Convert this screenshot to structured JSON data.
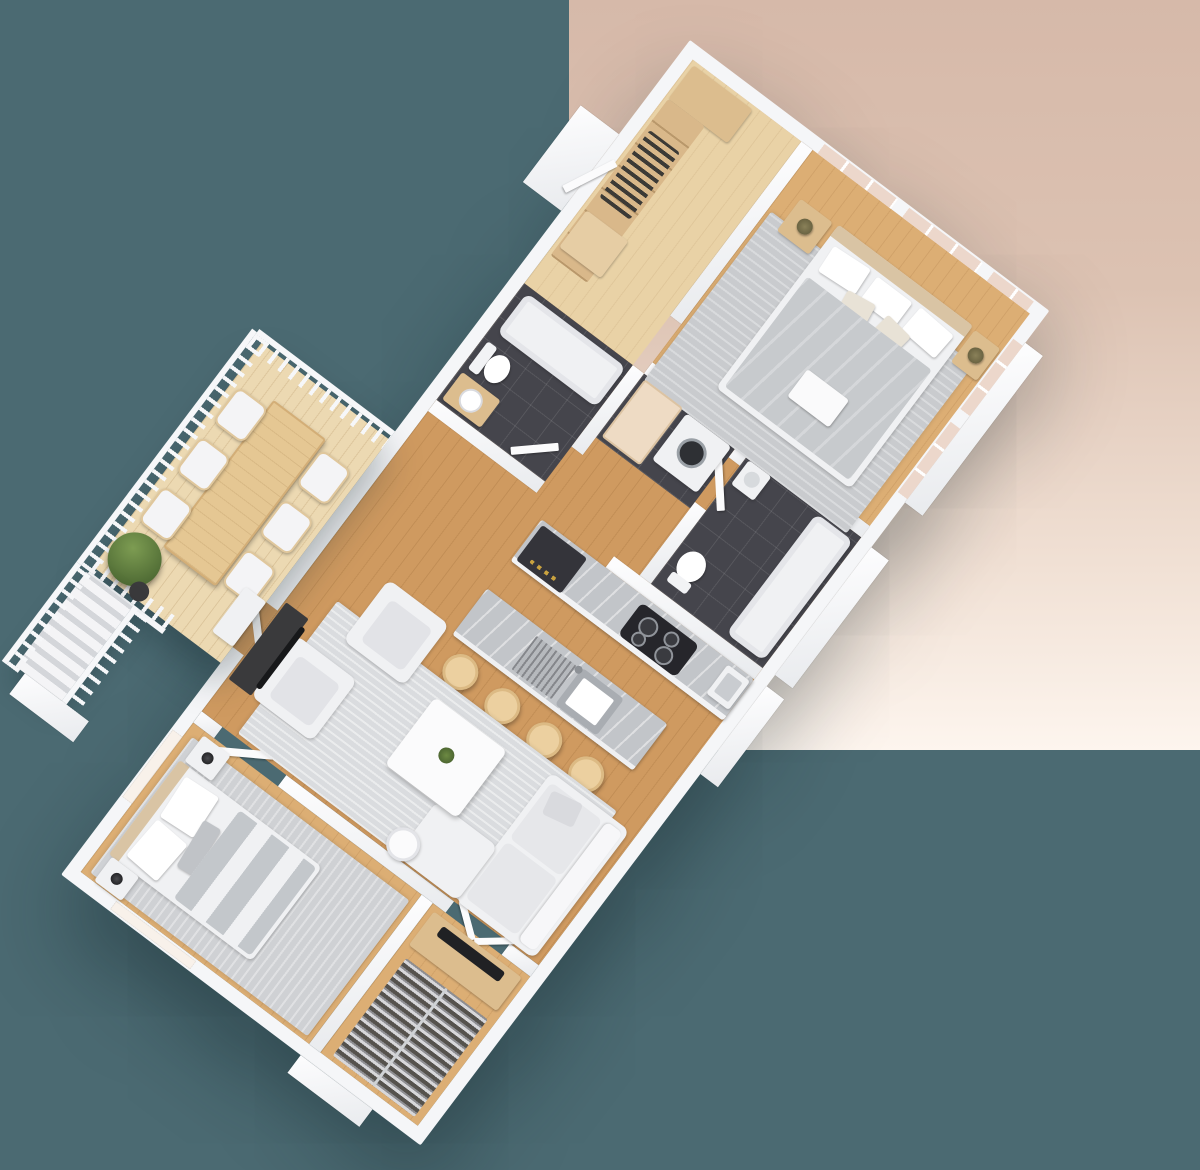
{
  "scene": {
    "type": "3d-floor-plan-render",
    "view": "isometric top-down, unit rotated diagonally",
    "visible_text": "none",
    "background": {
      "left_color": "#4b6a72",
      "panel_gradient_top": "#d6b9a9",
      "panel_gradient_bottom": "#fdf5ee",
      "panel_region": "upper-right rectangle"
    },
    "palette": {
      "walls": "#f5f6f8",
      "wood_floor": "#dcae74",
      "light_wood_floor": "#e9d2a6",
      "deck_floor": "#ecd9b2",
      "bathroom_tile": "#45454c",
      "rug": "#c9cbce",
      "counter_marble": "#c2c5c9",
      "upholstery": "#f0f1f3",
      "window_glass": "#ecd7cb"
    },
    "rooms": [
      {
        "name": "Entry foyer with closet",
        "floor": "light wood",
        "furniture": [
          "open shelving unit",
          "hanging clothes",
          "bench",
          "corner shelf"
        ]
      },
      {
        "name": "Primary bedroom",
        "floor": "wood",
        "furniture": [
          "double bed with gray duvet",
          "white pillows",
          "serving tray",
          "left nightstand with lamp",
          "right nightstand with lamp",
          "area rug"
        ]
      },
      {
        "name": "Main bathroom",
        "floor": "dark tile",
        "furniture": [
          "bathtub",
          "wall-hung toilet",
          "wood vanity with round sink"
        ]
      },
      {
        "name": "Laundry nook",
        "floor": "dark tile",
        "furniture": [
          "front-load washing machine",
          "beige work table"
        ]
      },
      {
        "name": "Ensuite bathroom",
        "floor": "dark tile",
        "furniture": [
          "bathtub",
          "toilet",
          "hand sink"
        ]
      },
      {
        "name": "Kitchen",
        "floor": "wood",
        "furniture": [
          "wall counter",
          "built-in oven and microwave block",
          "4-burner cooktop",
          "counter sink",
          "island with sink and drying rack",
          "4 wooden bar stools"
        ]
      },
      {
        "name": "Deck",
        "floor": "light decking",
        "furniture": [
          "wood dining table",
          "6 cushioned chairs",
          "potted shrub",
          "white railing with balusters",
          "exterior staircase",
          "entry step"
        ]
      },
      {
        "name": "Living room",
        "floor": "wood",
        "furniture": [
          "sofa with chaise",
          "2 armchairs",
          "white coffee table with plant",
          "TV console",
          "flat TV",
          "round side table",
          "area rug"
        ]
      },
      {
        "name": "Second bedroom",
        "floor": "wood",
        "furniture": [
          "double bed with striped duvet",
          "2 nightstands",
          "2 black lamps",
          "area rug"
        ]
      },
      {
        "name": "Walk-in closet",
        "floor": "wood",
        "furniture": [
          "wood console with TV",
          "long hanging-clothes rack",
          "V-opened double doors"
        ]
      }
    ],
    "counts": {
      "bar_stools": 4,
      "deck_chairs": 6,
      "bedrooms": 2,
      "bathrooms": 2
    }
  }
}
